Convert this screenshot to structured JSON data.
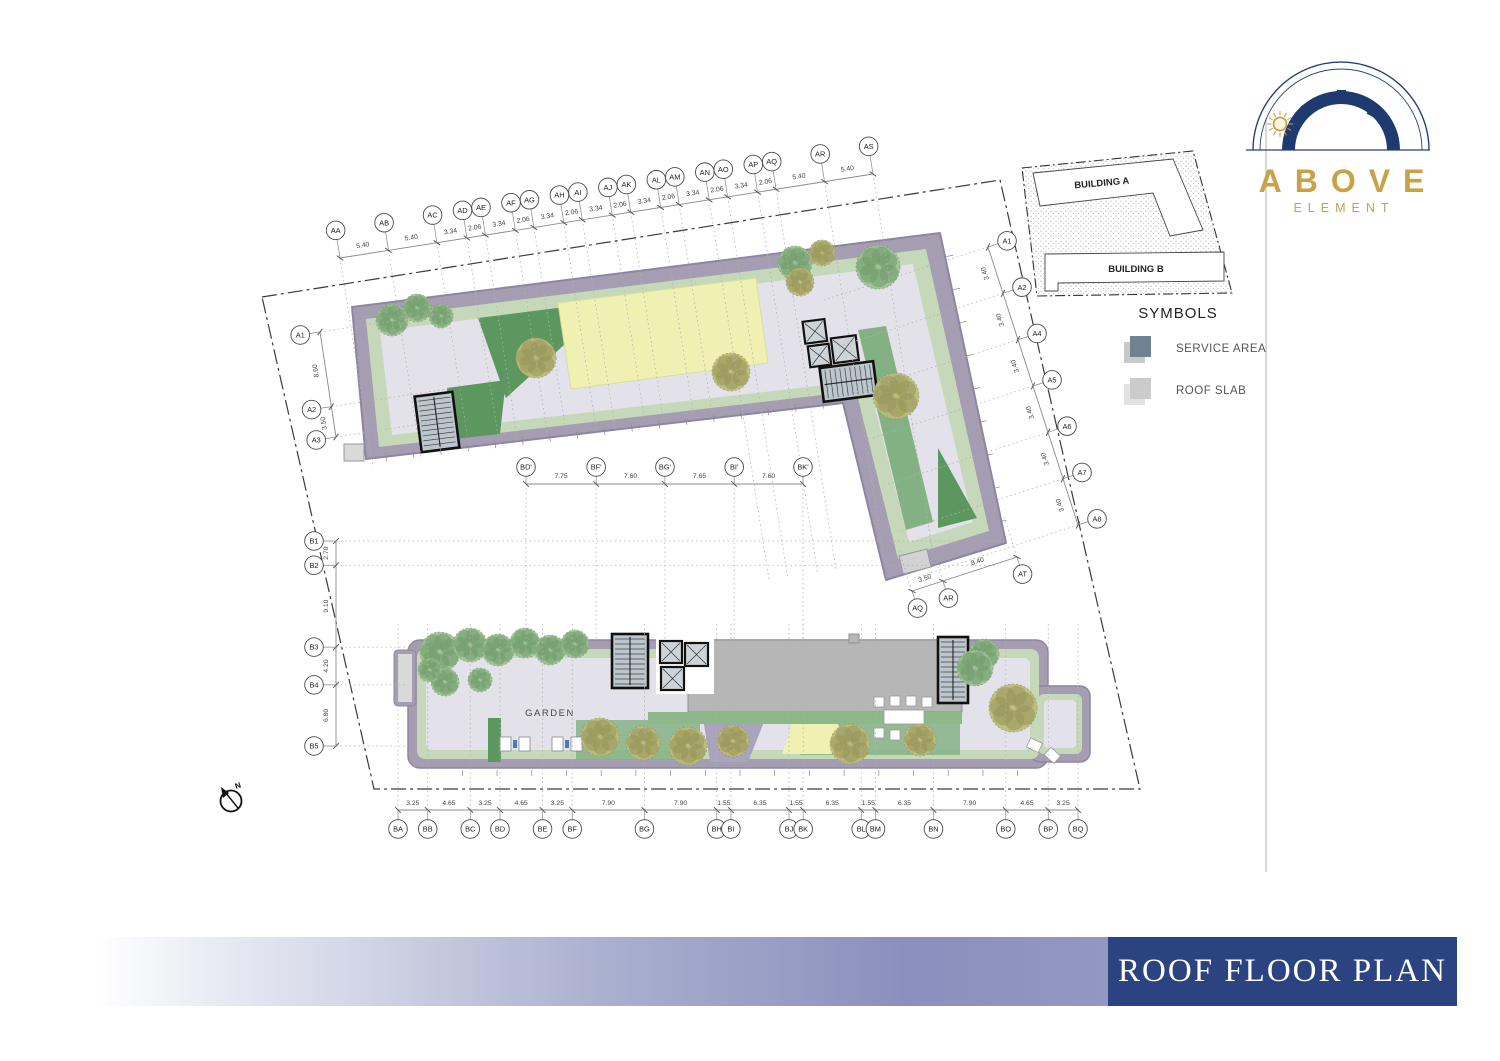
{
  "logo": {
    "title": "ABOVE",
    "subtitle": "ELEMENT",
    "navy": "#1f3a6e",
    "gold": "#c8a249"
  },
  "key_plan": {
    "building_a": "BUILDING A",
    "building_b": "BUILDING B"
  },
  "symbols": {
    "title": "SYMBOLS",
    "items": [
      {
        "label": "SERVICE AREA",
        "color": "#6e8294"
      },
      {
        "label": "ROOF SLAB",
        "color": "#cbcbcb"
      }
    ]
  },
  "title_block": {
    "text": "ROOF FLOOR PLAN",
    "bg_color": "#2b4380"
  },
  "plan": {
    "garden_label": "GARDEN",
    "north_label": "N",
    "grids": {
      "top": {
        "labels": [
          "AA",
          "AB",
          "AC",
          "AD",
          "AE",
          "AF",
          "AG",
          "AH",
          "AI",
          "AJ",
          "AK",
          "AL",
          "AM",
          "AN",
          "AO",
          "AP",
          "AQ",
          "AR",
          "AS"
        ],
        "dims": [
          "5.40",
          "5.40",
          "3.34",
          "2.06",
          "3.34",
          "2.06",
          "3.34",
          "2.06",
          "3.34",
          "2.06",
          "3.34",
          "2.06",
          "3.34",
          "2.06",
          "3.34",
          "2.06",
          "5.40",
          "5.40"
        ]
      },
      "right": {
        "labels": [
          "A1",
          "A2",
          "A4",
          "A5",
          "A6",
          "A7",
          "A8"
        ],
        "dims": [
          "3.40",
          "3.40",
          "3.40",
          "3.40",
          "3.40",
          "3.40"
        ]
      },
      "left_a": {
        "labels": [
          "A1",
          "A2",
          "A3"
        ],
        "dims": [
          "8.60",
          "3.50"
        ]
      },
      "left_b": {
        "labels": [
          "B1",
          "B2",
          "B3",
          "B4",
          "B5"
        ],
        "dims": [
          "2.70",
          "9.10",
          "4.20",
          "6.80"
        ]
      },
      "mid": {
        "labels": [
          "BD'",
          "BF'",
          "BG'",
          "BI'",
          "BK'"
        ],
        "dims": [
          "7.75",
          "7.60",
          "7.65",
          "7.60"
        ]
      },
      "bottom": {
        "labels": [
          "BA",
          "BB",
          "BC",
          "BD",
          "BE",
          "BF",
          "BG",
          "BH",
          "BI",
          "BJ",
          "BK",
          "BL",
          "BM",
          "BN",
          "BO",
          "BP",
          "BQ"
        ],
        "dims": [
          "3.25",
          "4.65",
          "3.25",
          "4.65",
          "3.25",
          "7.90",
          "7.90",
          "1.55",
          "6.35",
          "1.55",
          "6.35",
          "1.55",
          "6.35",
          "7.90",
          "4.65",
          "3.25"
        ]
      },
      "wing_bottom": {
        "labels": [
          "AQ",
          "AR",
          "AT"
        ],
        "dims": [
          "3.50",
          "8.40"
        ]
      }
    }
  }
}
